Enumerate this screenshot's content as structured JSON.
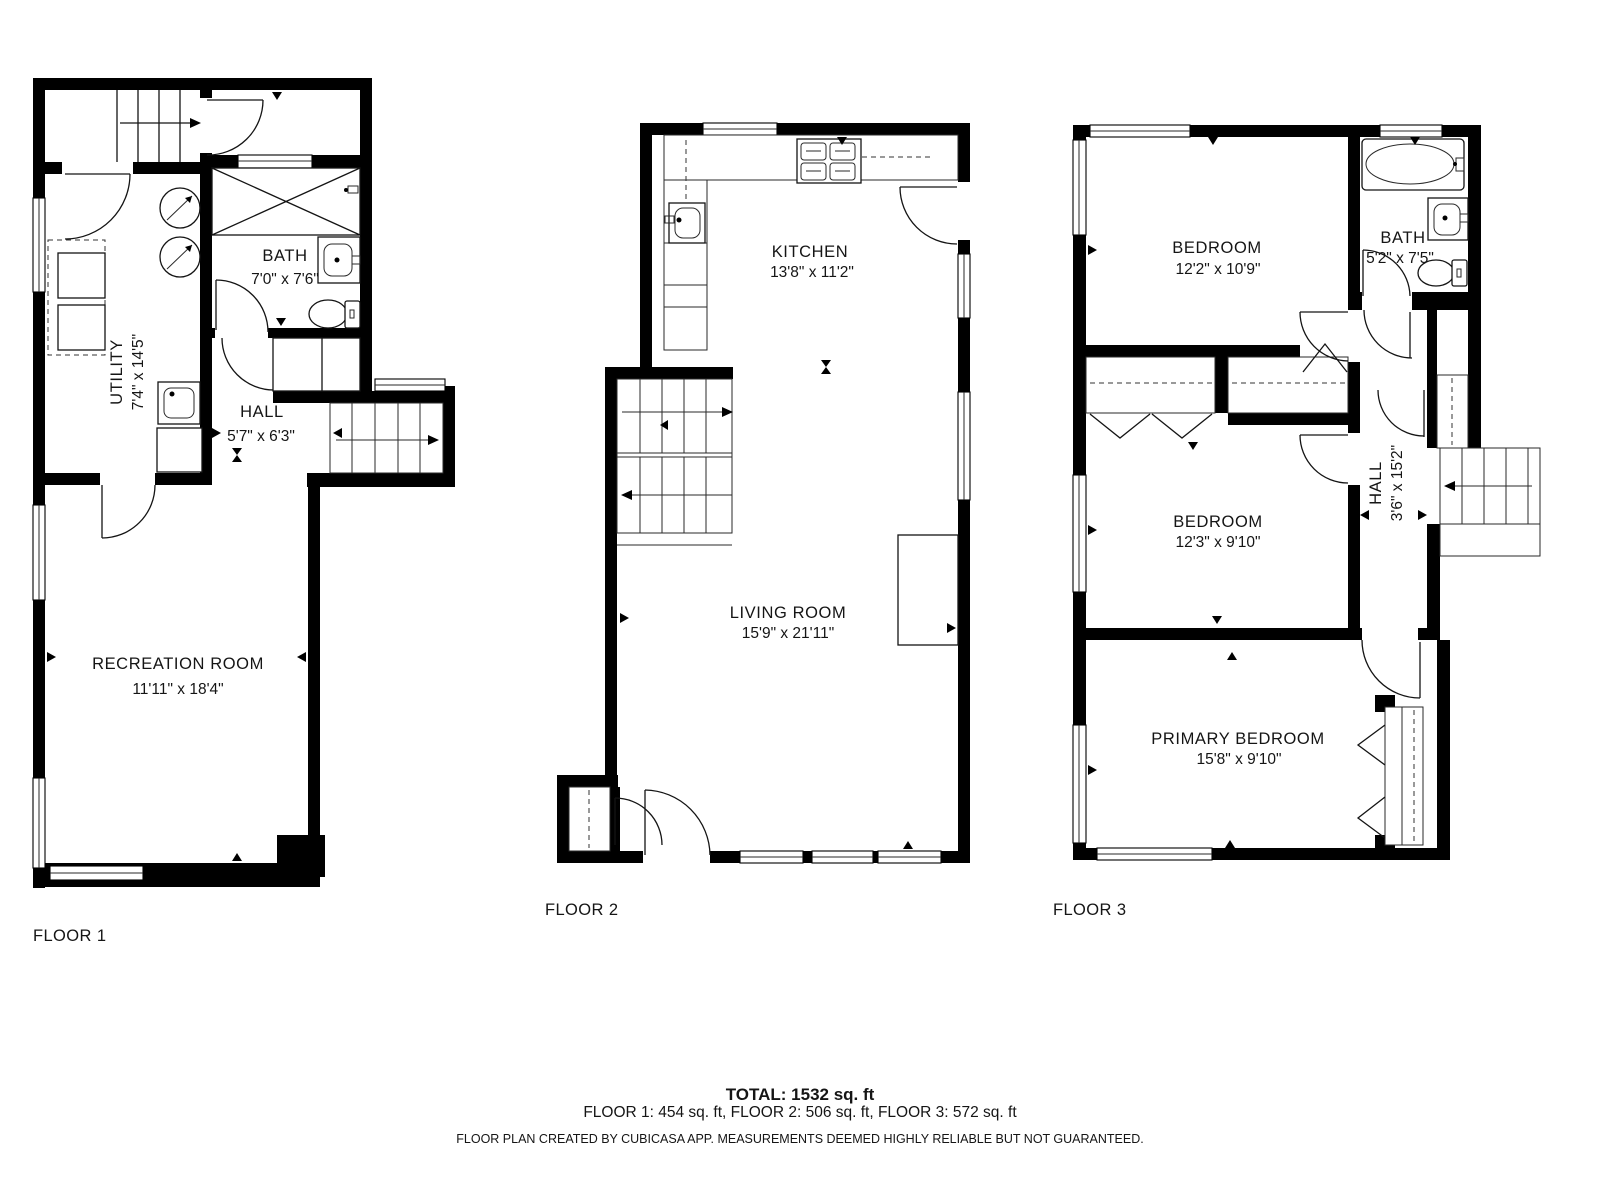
{
  "floors": [
    {
      "label": "FLOOR 1",
      "rooms": [
        {
          "name": "UTILITY",
          "dims": "7'4\" x 14'5\""
        },
        {
          "name": "BATH",
          "dims": "7'0\" x 7'6\""
        },
        {
          "name": "HALL",
          "dims": "5'7\" x 6'3\""
        },
        {
          "name": "RECREATION ROOM",
          "dims": "11'11\" x 18'4\""
        }
      ]
    },
    {
      "label": "FLOOR 2",
      "rooms": [
        {
          "name": "KITCHEN",
          "dims": "13'8\" x 11'2\""
        },
        {
          "name": "LIVING ROOM",
          "dims": "15'9\" x 21'11\""
        }
      ]
    },
    {
      "label": "FLOOR 3",
      "rooms": [
        {
          "name": "BEDROOM",
          "dims": "12'2\" x 10'9\""
        },
        {
          "name": "BATH",
          "dims": "5'2\" x 7'5\""
        },
        {
          "name": "BEDROOM",
          "dims": "12'3\" x 9'10\""
        },
        {
          "name": "HALL",
          "dims": "3'6\" x 15'2\""
        },
        {
          "name": "PRIMARY BEDROOM",
          "dims": "15'8\" x 9'10\""
        }
      ]
    }
  ],
  "footer": {
    "total": "TOTAL: 1532 sq. ft",
    "floor_areas": "FLOOR 1: 454 sq. ft, FLOOR 2: 506 sq. ft, FLOOR 3: 572 sq. ft",
    "disclaimer": "FLOOR PLAN CREATED BY CUBICASA APP. MEASUREMENTS DEEMED HIGHLY RELIABLE BUT NOT GUARANTEED."
  },
  "colors": {
    "wall": "#000000",
    "background": "#ffffff",
    "line": "#141414"
  }
}
